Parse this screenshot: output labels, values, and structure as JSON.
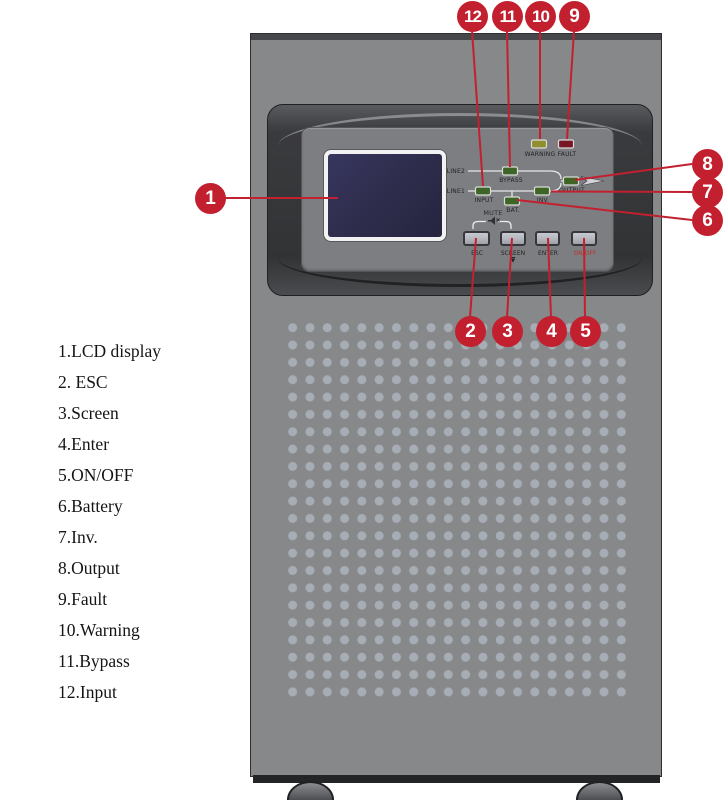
{
  "figure": {
    "subject": "UPS tower front panel diagram"
  },
  "colors": {
    "callout_red": "#C2202F",
    "led_green": "#3E6426",
    "led_yellow": "#8F8F2F",
    "led_red": "#781525",
    "body_gray": "#87888A",
    "onoff_text_red": "#B5342C"
  },
  "legend": {
    "items": [
      {
        "text": "1.LCD display"
      },
      {
        "text": "2. ESC"
      },
      {
        "text": "3.Screen"
      },
      {
        "text": "4.Enter"
      },
      {
        "text": "5.ON/OFF"
      },
      {
        "text": "6.Battery"
      },
      {
        "text": "7.Inv."
      },
      {
        "text": "8.Output"
      },
      {
        "text": "9.Fault"
      },
      {
        "text": "10.Warning"
      },
      {
        "text": "11.Bypass"
      },
      {
        "text": "12.Input"
      }
    ]
  },
  "callouts": {
    "n1": "1",
    "n2": "2",
    "n3": "3",
    "n4": "4",
    "n5": "5",
    "n6": "6",
    "n7": "7",
    "n8": "8",
    "n9": "9",
    "n10": "10",
    "n11": "11",
    "n12": "12"
  },
  "panel": {
    "led_labels": {
      "warning": "WARNING",
      "fault": "FAULT",
      "bypass": "BYPASS",
      "input": "INPUT",
      "inv": "INV.",
      "bat": "BAT.",
      "output": "OUTPUT"
    },
    "line_labels": {
      "line2": "LINE2",
      "line1": "LINE1"
    },
    "mute_label": "MUTE",
    "buttons": {
      "esc": "ESC",
      "screen": "SCREEN",
      "screen_sub": "▼",
      "enter": "ENTER",
      "onoff": "ON/OFF"
    }
  }
}
